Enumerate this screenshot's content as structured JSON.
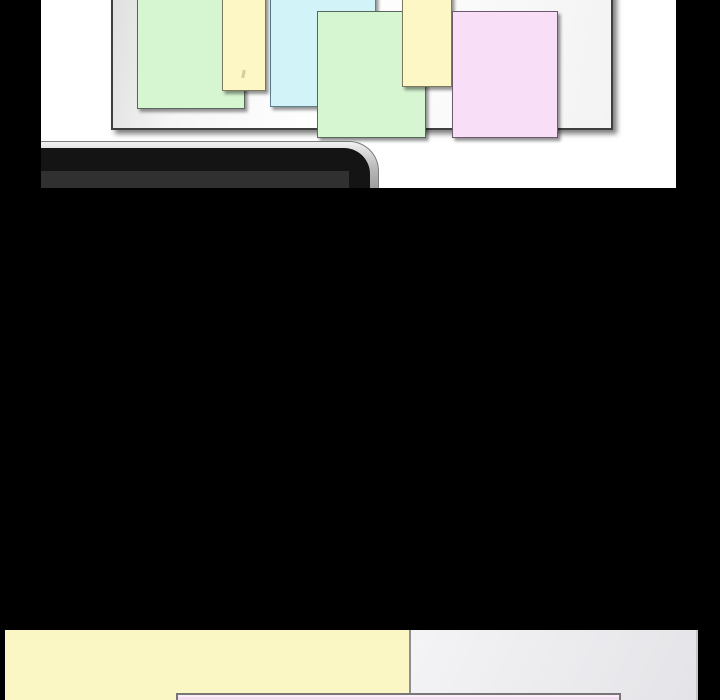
{
  "page": {
    "background": "#000000"
  },
  "top_panel": {
    "background": "#ffffff",
    "whiteboard": {
      "border": "#3f3f3f",
      "fill_edge": "#dedede",
      "fill_center": "#ffffff"
    },
    "notes": [
      {
        "name": "green-note-1",
        "fill": "#d5f6d0",
        "border": "#58695c"
      },
      {
        "name": "yellow-note-1",
        "fill": "#fcf7c5",
        "border": "#7e795c"
      },
      {
        "name": "cyan-note-1",
        "fill": "#d2f4f8",
        "border": "#5d808d"
      },
      {
        "name": "green-note-2",
        "fill": "#d5f6d0",
        "border": "#58695c"
      },
      {
        "name": "yellow-note-2",
        "fill": "#fcf7c5",
        "border": "#7e795c"
      },
      {
        "name": "pink-note-1",
        "fill": "#f9def8",
        "border": "#6e5a6e"
      }
    ],
    "laptop": {
      "edge": "#bdbdbd",
      "edge_dark": "#8c8c8c",
      "body": "#141414",
      "strip": "#303030"
    }
  },
  "bottom_left_panel": {
    "background": "#fbf7c5"
  },
  "bottom_right_panel": {
    "background_start": "#f4f4f6",
    "background_end": "#e4e4e8",
    "divider": "#8f8f93"
  },
  "dialog_box": {
    "fill": "#f3ddf0",
    "border": "#777777",
    "highlight": "#fbeef9"
  }
}
